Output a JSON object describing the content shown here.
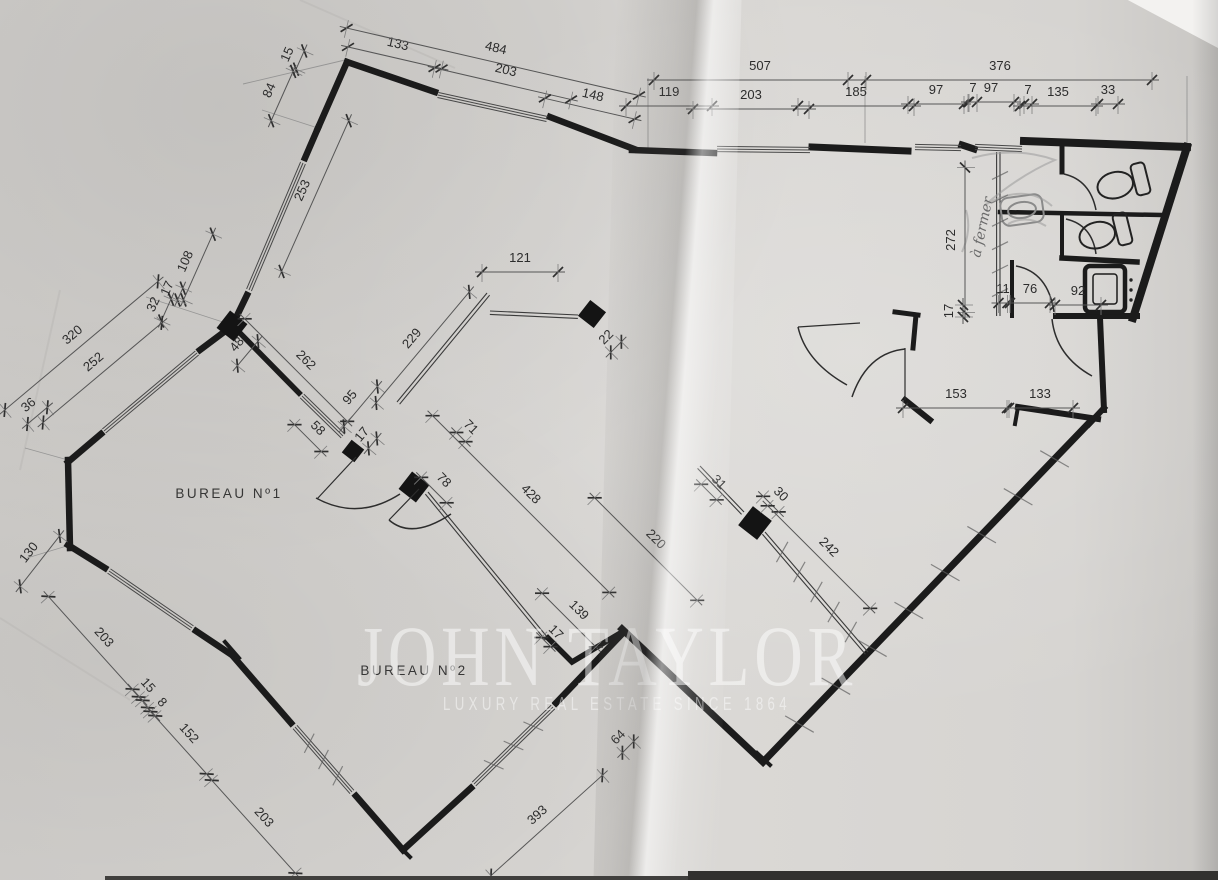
{
  "rooms": {
    "room1": "BUREAU  Nº1",
    "room2": "BUREAU  Nº2"
  },
  "handwritten_note": "à fermer",
  "watermark": {
    "title": "JOHN TAYLOR",
    "subtitle": "LUXURY REAL ESTATE SINCE 1864"
  },
  "colors": {
    "ink": "#1b1b1b",
    "pencil": "#9a9a9a",
    "paper": "#d5d3d0"
  },
  "dims": [
    {
      "label": "15",
      "x": 291,
      "y": 56,
      "rot": -66,
      "len": 20
    },
    {
      "label": "84",
      "x": 273,
      "y": 92,
      "rot": -66,
      "len": 54
    },
    {
      "label": "253",
      "x": 306,
      "y": 192,
      "rot": -66,
      "len": 165
    },
    {
      "label": "108",
      "x": 189,
      "y": 263,
      "rot": -66,
      "len": 72
    },
    {
      "label": "17",
      "x": 171,
      "y": 290,
      "rot": -66,
      "len": 13
    },
    {
      "label": "32",
      "x": 157,
      "y": 306,
      "rot": -66,
      "len": 24
    },
    {
      "label": "133",
      "x": 397,
      "y": 48,
      "rot": 13,
      "len": 96
    },
    {
      "label": "484",
      "x": 495,
      "y": 52,
      "rot": 13,
      "len": 300
    },
    {
      "label": "203",
      "x": 505,
      "y": 74,
      "rot": 13,
      "len": 140
    },
    {
      "label": "148",
      "x": 592,
      "y": 99,
      "rot": 13,
      "len": 92
    },
    {
      "label": "507",
      "x": 760,
      "y": 70,
      "rot": 0,
      "len": 212
    },
    {
      "label": "376",
      "x": 1000,
      "y": 70,
      "rot": 0,
      "len": 304
    },
    {
      "label": "119",
      "x": 669,
      "y": 96,
      "rot": 0,
      "len": 86
    },
    {
      "label": "203",
      "x": 751,
      "y": 99,
      "rot": 0,
      "len": 116
    },
    {
      "label": "185",
      "x": 856,
      "y": 96,
      "rot": 0,
      "len": 116
    },
    {
      "label": "97",
      "x": 936,
      "y": 94,
      "rot": 0,
      "len": 56
    },
    {
      "label": "7",
      "x": 973,
      "y": 92,
      "rot": 0,
      "len": 8
    },
    {
      "label": "97",
      "x": 991,
      "y": 92,
      "rot": 0,
      "len": 46
    },
    {
      "label": "7",
      "x": 1028,
      "y": 94,
      "rot": 0,
      "len": 8
    },
    {
      "label": "135",
      "x": 1058,
      "y": 96,
      "rot": 0,
      "len": 76
    },
    {
      "label": "33",
      "x": 1108,
      "y": 94,
      "rot": 0,
      "len": 20
    },
    {
      "label": "320",
      "x": 75,
      "y": 338,
      "rot": -40,
      "len": 200
    },
    {
      "label": "252",
      "x": 96,
      "y": 365,
      "rot": -40,
      "len": 155
    },
    {
      "label": "36",
      "x": 31,
      "y": 408,
      "rot": -40,
      "len": 26
    },
    {
      "label": "130",
      "x": 32,
      "y": 555,
      "rot": -52,
      "len": 64
    },
    {
      "label": "203",
      "x": 101,
      "y": 640,
      "rot": 48,
      "len": 135
    },
    {
      "label": "15",
      "x": 145,
      "y": 688,
      "rot": 48,
      "len": 15
    },
    {
      "label": "8",
      "x": 159,
      "y": 705,
      "rot": 48,
      "len": 11
    },
    {
      "label": "152",
      "x": 186,
      "y": 736,
      "rot": 48,
      "len": 84
    },
    {
      "label": "203",
      "x": 261,
      "y": 820,
      "rot": 48,
      "len": 125
    },
    {
      "label": "393",
      "x": 540,
      "y": 818,
      "rot": -42,
      "len": 150
    },
    {
      "label": "64",
      "x": 621,
      "y": 740,
      "rot": -45,
      "len": 16
    },
    {
      "label": "48",
      "x": 240,
      "y": 347,
      "rot": -50,
      "len": 32
    },
    {
      "label": "262",
      "x": 303,
      "y": 363,
      "rot": 45,
      "len": 145
    },
    {
      "label": "58",
      "x": 315,
      "y": 431,
      "rot": 45,
      "len": 38
    },
    {
      "label": "95",
      "x": 353,
      "y": 400,
      "rot": -50,
      "len": 52
    },
    {
      "label": "17",
      "x": 365,
      "y": 437,
      "rot": -50,
      "len": 13
    },
    {
      "label": "229",
      "x": 415,
      "y": 341,
      "rot": -50,
      "len": 145
    },
    {
      "label": "121",
      "x": 520,
      "y": 262,
      "rot": 0,
      "len": 76
    },
    {
      "label": "22",
      "x": 609,
      "y": 340,
      "rot": -45,
      "len": 15
    },
    {
      "label": "71",
      "x": 468,
      "y": 430,
      "rot": 45,
      "len": 13
    },
    {
      "label": "78",
      "x": 441,
      "y": 483,
      "rot": 45,
      "len": 36
    },
    {
      "label": "428",
      "x": 528,
      "y": 497,
      "rot": 45,
      "len": 250
    },
    {
      "label": "220",
      "x": 653,
      "y": 542,
      "rot": 45,
      "len": 145
    },
    {
      "label": "31",
      "x": 716,
      "y": 485,
      "rot": 45,
      "len": 22
    },
    {
      "label": "30",
      "x": 778,
      "y": 497,
      "rot": 45,
      "len": 22
    },
    {
      "label": "139",
      "x": 576,
      "y": 613,
      "rot": 45,
      "len": 76
    },
    {
      "label": "17",
      "x": 553,
      "y": 635,
      "rot": 45,
      "len": 13
    },
    {
      "label": "242",
      "x": 826,
      "y": 550,
      "rot": 45,
      "len": 145
    },
    {
      "label": "153",
      "x": 956,
      "y": 398,
      "rot": 0,
      "len": 106
    },
    {
      "label": "133",
      "x": 1040,
      "y": 398,
      "rot": 0,
      "len": 66
    },
    {
      "label": "272",
      "x": 955,
      "y": 240,
      "rot": -90,
      "len": 145
    },
    {
      "label": "17",
      "x": 953,
      "y": 311,
      "rot": -90,
      "len": 12
    },
    {
      "label": "11",
      "x": 1003,
      "y": 293,
      "rot": 0,
      "len": 9
    },
    {
      "label": "76",
      "x": 1030,
      "y": 293,
      "rot": 0,
      "len": 40
    },
    {
      "label": "92",
      "x": 1078,
      "y": 295,
      "rot": 0,
      "len": 46
    }
  ]
}
